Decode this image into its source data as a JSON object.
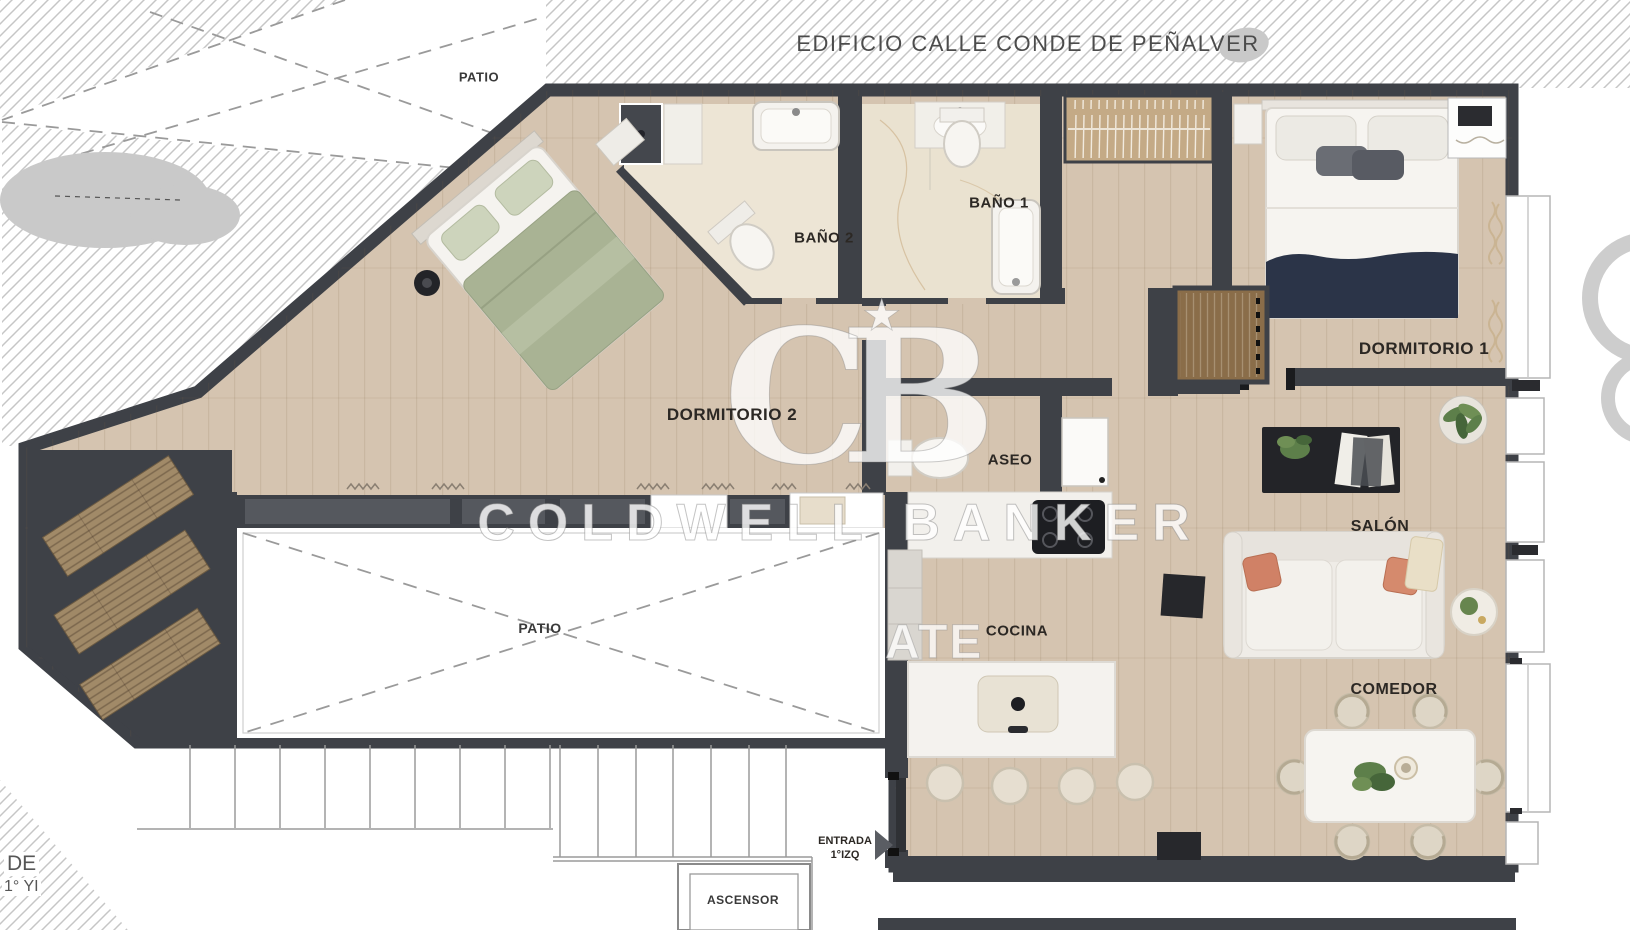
{
  "building": {
    "label": "EDIFICIO CALLE CONDE DE PEÑALVER"
  },
  "rooms": {
    "dormitorio2": "DORMITORIO 2",
    "dormitorio1": "DORMITORIO 1",
    "bano2": "BAÑO 2",
    "bano1": "BAÑO 1",
    "aseo": "ASEO",
    "salon": "SALÓN",
    "cocina": "COCINA",
    "comedor": "COMEDOR"
  },
  "areas": {
    "patio_top": "PATIO",
    "patio_central": "PATIO",
    "ascensor": "ASCENSOR"
  },
  "entrance": {
    "line1": "ENTRADA",
    "line2": "1°IZQ"
  },
  "edge_text": {
    "line1": "DE",
    "line2": "1° YI"
  },
  "watermark": {
    "monogram": "CB",
    "star": "★",
    "name": "COLDWELL BANKER",
    "fragment": "ATE"
  },
  "colors": {
    "wall": "#3e4147",
    "wood": "#d5c4b0",
    "tile": "#ece4d4",
    "bed_green": "#a9b394",
    "bed_navy": "#2b3448",
    "pillow_orange": "#d08166",
    "hatch": "#c6c6c6"
  }
}
